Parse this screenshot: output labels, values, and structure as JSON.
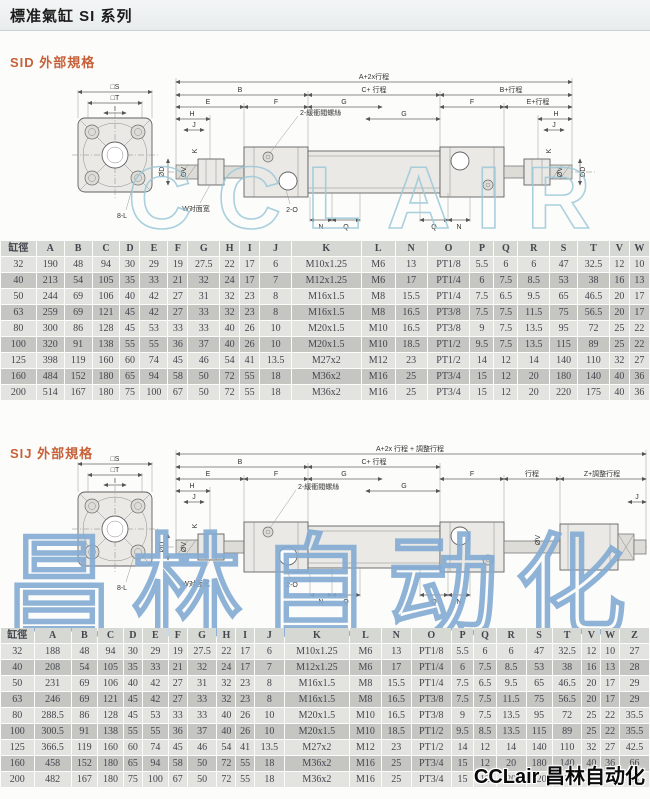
{
  "page": {
    "title": "標准氣缸 SI 系列",
    "logo_text": "CCLair 昌林自动化",
    "watermark1": "CCLAIR",
    "watermark2": "昌林自动化",
    "accent_color": "#c6613a"
  },
  "sid": {
    "heading": "SID 外部規格",
    "drawing": {
      "square_s": "□S",
      "square_t": "□T",
      "square_i": "I",
      "holes": "8-L",
      "total": "A+2x行程",
      "b": "B",
      "c_stroke": "C+ 行程",
      "b_stroke": "B+行程",
      "e": "E",
      "f": "F",
      "g": "G",
      "e_stroke": "E+行程",
      "h": "H",
      "j": "J",
      "cushion": "2-緩衝閥螺絲",
      "port": "2-O",
      "flats": "W对面宽",
      "n": "N",
      "q": "Q",
      "od": "ØD",
      "ov": "ØV",
      "k": "K"
    },
    "table": {
      "headers": [
        "缸徑",
        "A",
        "B",
        "C",
        "D",
        "E",
        "F",
        "G",
        "H",
        "I",
        "J",
        "K",
        "L",
        "N",
        "O",
        "P",
        "Q",
        "R",
        "S",
        "T",
        "V",
        "W"
      ],
      "rows": [
        [
          "32",
          "190",
          "48",
          "94",
          "30",
          "29",
          "19",
          "27.5",
          "22",
          "17",
          "6",
          "M10x1.25",
          "M6",
          "13",
          "PT1/8",
          "5.5",
          "6",
          "6",
          "47",
          "32.5",
          "12",
          "10"
        ],
        [
          "40",
          "213",
          "54",
          "105",
          "35",
          "33",
          "21",
          "32",
          "24",
          "17",
          "7",
          "M12x1.25",
          "M6",
          "17",
          "PT1/4",
          "6",
          "7.5",
          "8.5",
          "53",
          "38",
          "16",
          "13"
        ],
        [
          "50",
          "244",
          "69",
          "106",
          "40",
          "42",
          "27",
          "31",
          "32",
          "23",
          "8",
          "M16x1.5",
          "M8",
          "15.5",
          "PT1/4",
          "7.5",
          "6.5",
          "9.5",
          "65",
          "46.5",
          "20",
          "17"
        ],
        [
          "63",
          "259",
          "69",
          "121",
          "45",
          "42",
          "27",
          "33",
          "32",
          "23",
          "8",
          "M16x1.5",
          "M8",
          "16.5",
          "PT3/8",
          "7.5",
          "7.5",
          "11.5",
          "75",
          "56.5",
          "20",
          "17"
        ],
        [
          "80",
          "300",
          "86",
          "128",
          "45",
          "53",
          "33",
          "33",
          "40",
          "26",
          "10",
          "M20x1.5",
          "M10",
          "16.5",
          "PT3/8",
          "9",
          "7.5",
          "13.5",
          "95",
          "72",
          "25",
          "22"
        ],
        [
          "100",
          "320",
          "91",
          "138",
          "55",
          "55",
          "36",
          "37",
          "40",
          "26",
          "10",
          "M20x1.5",
          "M10",
          "18.5",
          "PT1/2",
          "9.5",
          "7.5",
          "13.5",
          "115",
          "89",
          "25",
          "22"
        ],
        [
          "125",
          "398",
          "119",
          "160",
          "60",
          "74",
          "45",
          "46",
          "54",
          "41",
          "13.5",
          "M27x2",
          "M12",
          "23",
          "PT1/2",
          "14",
          "12",
          "14",
          "140",
          "110",
          "32",
          "27"
        ],
        [
          "160",
          "484",
          "152",
          "180",
          "65",
          "94",
          "58",
          "50",
          "72",
          "55",
          "18",
          "M36x2",
          "M16",
          "25",
          "PT3/4",
          "15",
          "12",
          "20",
          "180",
          "140",
          "40",
          "36"
        ],
        [
          "200",
          "514",
          "167",
          "180",
          "75",
          "100",
          "67",
          "50",
          "72",
          "55",
          "18",
          "M36x2",
          "M16",
          "25",
          "PT3/4",
          "15",
          "12",
          "20",
          "220",
          "175",
          "40",
          "36"
        ]
      ]
    }
  },
  "sij": {
    "heading": "SIJ 外部規格",
    "drawing": {
      "square_s": "□S",
      "square_t": "□T",
      "square_i": "I",
      "holes": "8-L",
      "total": "A+2x 行程 + 調整行程",
      "b": "B",
      "c_stroke": "C+ 行程",
      "e": "E",
      "f": "F",
      "g": "G",
      "stroke": "行程",
      "z_adjust": "Z+調整行程",
      "h": "H",
      "j": "J",
      "cushion": "2-緩衝閥螺絲",
      "port": "2-O",
      "flats": "W对面宽",
      "n": "N",
      "q": "Q",
      "od": "ØD",
      "ov": "ØV",
      "k": "K"
    },
    "table": {
      "headers": [
        "缸徑",
        "A",
        "B",
        "C",
        "D",
        "E",
        "F",
        "G",
        "H",
        "I",
        "J",
        "K",
        "L",
        "N",
        "O",
        "P",
        "Q",
        "R",
        "S",
        "T",
        "V",
        "W",
        "Z"
      ],
      "rows": [
        [
          "32",
          "188",
          "48",
          "94",
          "30",
          "29",
          "19",
          "27.5",
          "22",
          "17",
          "6",
          "M10x1.25",
          "M6",
          "13",
          "PT1/8",
          "5.5",
          "6",
          "6",
          "47",
          "32.5",
          "12",
          "10",
          "27"
        ],
        [
          "40",
          "208",
          "54",
          "105",
          "35",
          "33",
          "21",
          "32",
          "24",
          "17",
          "7",
          "M12x1.25",
          "M6",
          "17",
          "PT1/4",
          "6",
          "7.5",
          "8.5",
          "53",
          "38",
          "16",
          "13",
          "28"
        ],
        [
          "50",
          "231",
          "69",
          "106",
          "40",
          "42",
          "27",
          "31",
          "32",
          "23",
          "8",
          "M16x1.5",
          "M8",
          "15.5",
          "PT1/4",
          "7.5",
          "6.5",
          "9.5",
          "65",
          "46.5",
          "20",
          "17",
          "29"
        ],
        [
          "63",
          "246",
          "69",
          "121",
          "45",
          "42",
          "27",
          "33",
          "32",
          "23",
          "8",
          "M16x1.5",
          "M8",
          "16.5",
          "PT3/8",
          "7.5",
          "7.5",
          "11.5",
          "75",
          "56.5",
          "20",
          "17",
          "29"
        ],
        [
          "80",
          "288.5",
          "86",
          "128",
          "45",
          "53",
          "33",
          "33",
          "40",
          "26",
          "10",
          "M20x1.5",
          "M10",
          "16.5",
          "PT3/8",
          "9",
          "7.5",
          "13.5",
          "95",
          "72",
          "25",
          "22",
          "35.5"
        ],
        [
          "100",
          "300.5",
          "91",
          "138",
          "55",
          "55",
          "36",
          "37",
          "40",
          "26",
          "10",
          "M20x1.5",
          "M10",
          "18.5",
          "PT1/2",
          "9.5",
          "8.5",
          "13.5",
          "115",
          "89",
          "25",
          "22",
          "35.5"
        ],
        [
          "125",
          "366.5",
          "119",
          "160",
          "60",
          "74",
          "45",
          "46",
          "54",
          "41",
          "13.5",
          "M27x2",
          "M12",
          "23",
          "PT1/2",
          "14",
          "12",
          "14",
          "140",
          "110",
          "32",
          "27",
          "42.5"
        ],
        [
          "160",
          "458",
          "152",
          "180",
          "65",
          "94",
          "58",
          "50",
          "72",
          "55",
          "18",
          "M36x2",
          "M16",
          "25",
          "PT3/4",
          "15",
          "12",
          "20",
          "180",
          "140",
          "40",
          "36",
          "66"
        ],
        [
          "200",
          "482",
          "167",
          "180",
          "75",
          "100",
          "67",
          "50",
          "72",
          "55",
          "18",
          "M36x2",
          "M16",
          "25",
          "PT3/4",
          "15",
          "12",
          "20",
          "220",
          "175",
          "40",
          "36",
          "68"
        ]
      ]
    }
  }
}
